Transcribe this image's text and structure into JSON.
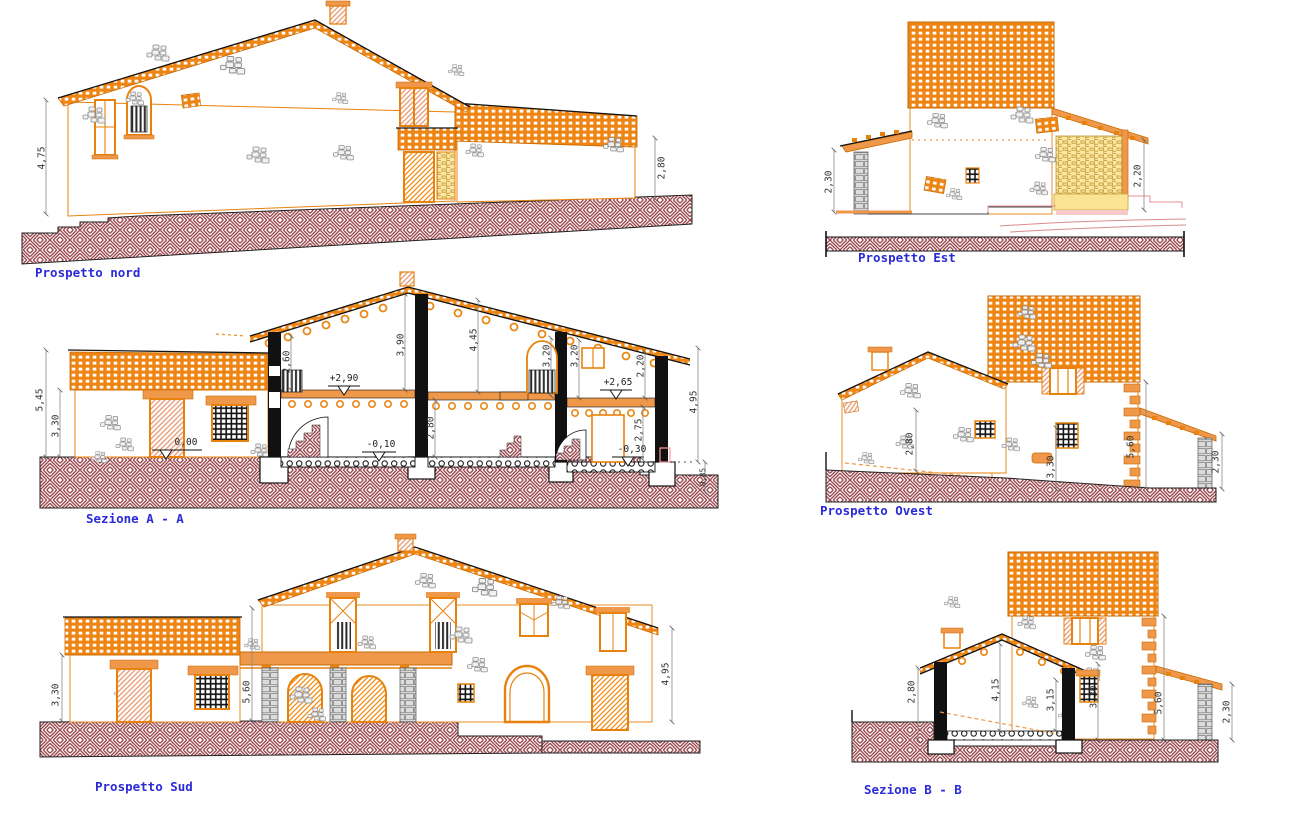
{
  "sheet": {
    "kind": "architectural elevations and sections"
  },
  "colors": {
    "accent_orange": "#ee8412",
    "roof_border": "#c96a00",
    "ground_hatch": "#9c4b51",
    "title_blue": "#2a2ad8",
    "dim_text": "#333333",
    "lattice_yellow": "#fbe7a2",
    "terrain_pink": "#e89090"
  },
  "panels": {
    "nord": {
      "title": "Prospetto nord",
      "dims": {
        "h_left": "4,75",
        "h_right": "2,80"
      }
    },
    "sezA": {
      "title": "Sezione A - A",
      "dims": {
        "d545": "5,45",
        "d330": "3,30",
        "d260": "2,60",
        "d390": "3,90",
        "d445": "4,45",
        "d280": "2,80",
        "d320a": "3,20",
        "d320b": "3,20",
        "d220": "2,20",
        "d275": "2,75",
        "d495": "4,95",
        "d085": "0,85"
      },
      "levels": {
        "l000": "0,00",
        "l290": "+2,90",
        "l010": "-0,10",
        "l265": "+2,65",
        "l030": "-0,30"
      }
    },
    "sud": {
      "title": "Prospetto Sud",
      "dims": {
        "d330": "3,30",
        "d560": "5,60",
        "d495": "4,95"
      }
    },
    "est": {
      "title": "Prospetto Est",
      "dims": {
        "d230": "2,30",
        "d220": "2,20"
      }
    },
    "ovest": {
      "title": "Prospetto Ovest",
      "dims": {
        "d280": "2,80",
        "d330": "3,30",
        "d560": "5,60",
        "d230": "2,30"
      }
    },
    "sezB": {
      "title": "Sezione B - B",
      "dims": {
        "d280": "2,80",
        "d415": "4,15",
        "d315": "3,15",
        "d330": "3,30",
        "d560": "5,60",
        "d230": "2,30"
      }
    }
  }
}
